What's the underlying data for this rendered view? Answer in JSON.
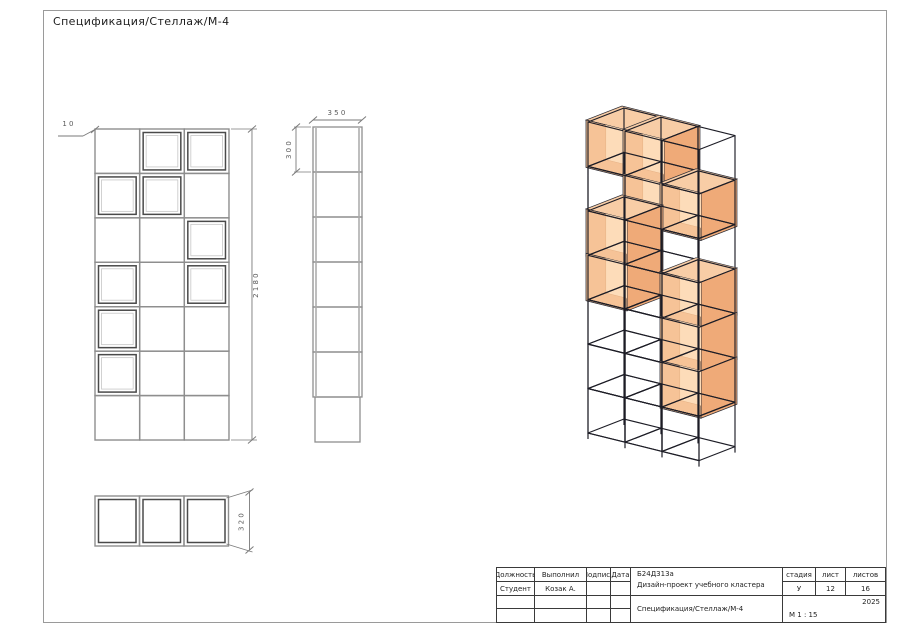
{
  "page": {
    "title": "Спецификация/Стеллаж/М-4"
  },
  "colors": {
    "grid": "#8e8e8e",
    "box_dark": "#4a4a4a",
    "box_light": "#c6c6c6",
    "dim": "#7a7a7a",
    "dim_text": "#5a5a5a",
    "frame_line": "#1d1d26",
    "face_top": "#f8cda6",
    "face_side": "#efaa78",
    "face_interior": "#f6c397",
    "face_back": "#fddcb9",
    "face_edge": "#2b2b33"
  },
  "front_view": {
    "pattern": [
      [
        0,
        1,
        1
      ],
      [
        1,
        1,
        0
      ],
      [
        0,
        0,
        1
      ],
      [
        1,
        0,
        1
      ],
      [
        1,
        0,
        0
      ],
      [
        1,
        0,
        0
      ],
      [
        0,
        0,
        0
      ]
    ],
    "dim_height": "2180",
    "dim_note": "10"
  },
  "side_view": {
    "cells": 7,
    "dim_width": "350",
    "dim_cell_height": "300"
  },
  "bottom_view": {
    "cells": 3,
    "dim_depth": "320"
  },
  "iso_view": {
    "pattern": [
      [
        1,
        1,
        0
      ],
      [
        0,
        1,
        1
      ],
      [
        1,
        0,
        0
      ],
      [
        1,
        0,
        1
      ],
      [
        0,
        0,
        1
      ],
      [
        0,
        0,
        1
      ],
      [
        0,
        0,
        0
      ]
    ]
  },
  "title_block": {
    "position_header": "Должность",
    "performed_header": "Выполнил",
    "signature_header": "Подпись",
    "date_header": "Дата",
    "position_value": "Студент",
    "performed_value": "Козак А.",
    "project_code": "Б24Д313а",
    "project_name": "Дизайн-проект учебного кластера",
    "doc_title": "Спецификация/Стеллаж/М-4",
    "stage_header": "стадия",
    "sheet_header": "лист",
    "sheets_header": "листов",
    "stage_value": "У",
    "sheet_value": "12",
    "sheets_value": "16",
    "year": "2025",
    "scale": "М 1 : 15"
  }
}
